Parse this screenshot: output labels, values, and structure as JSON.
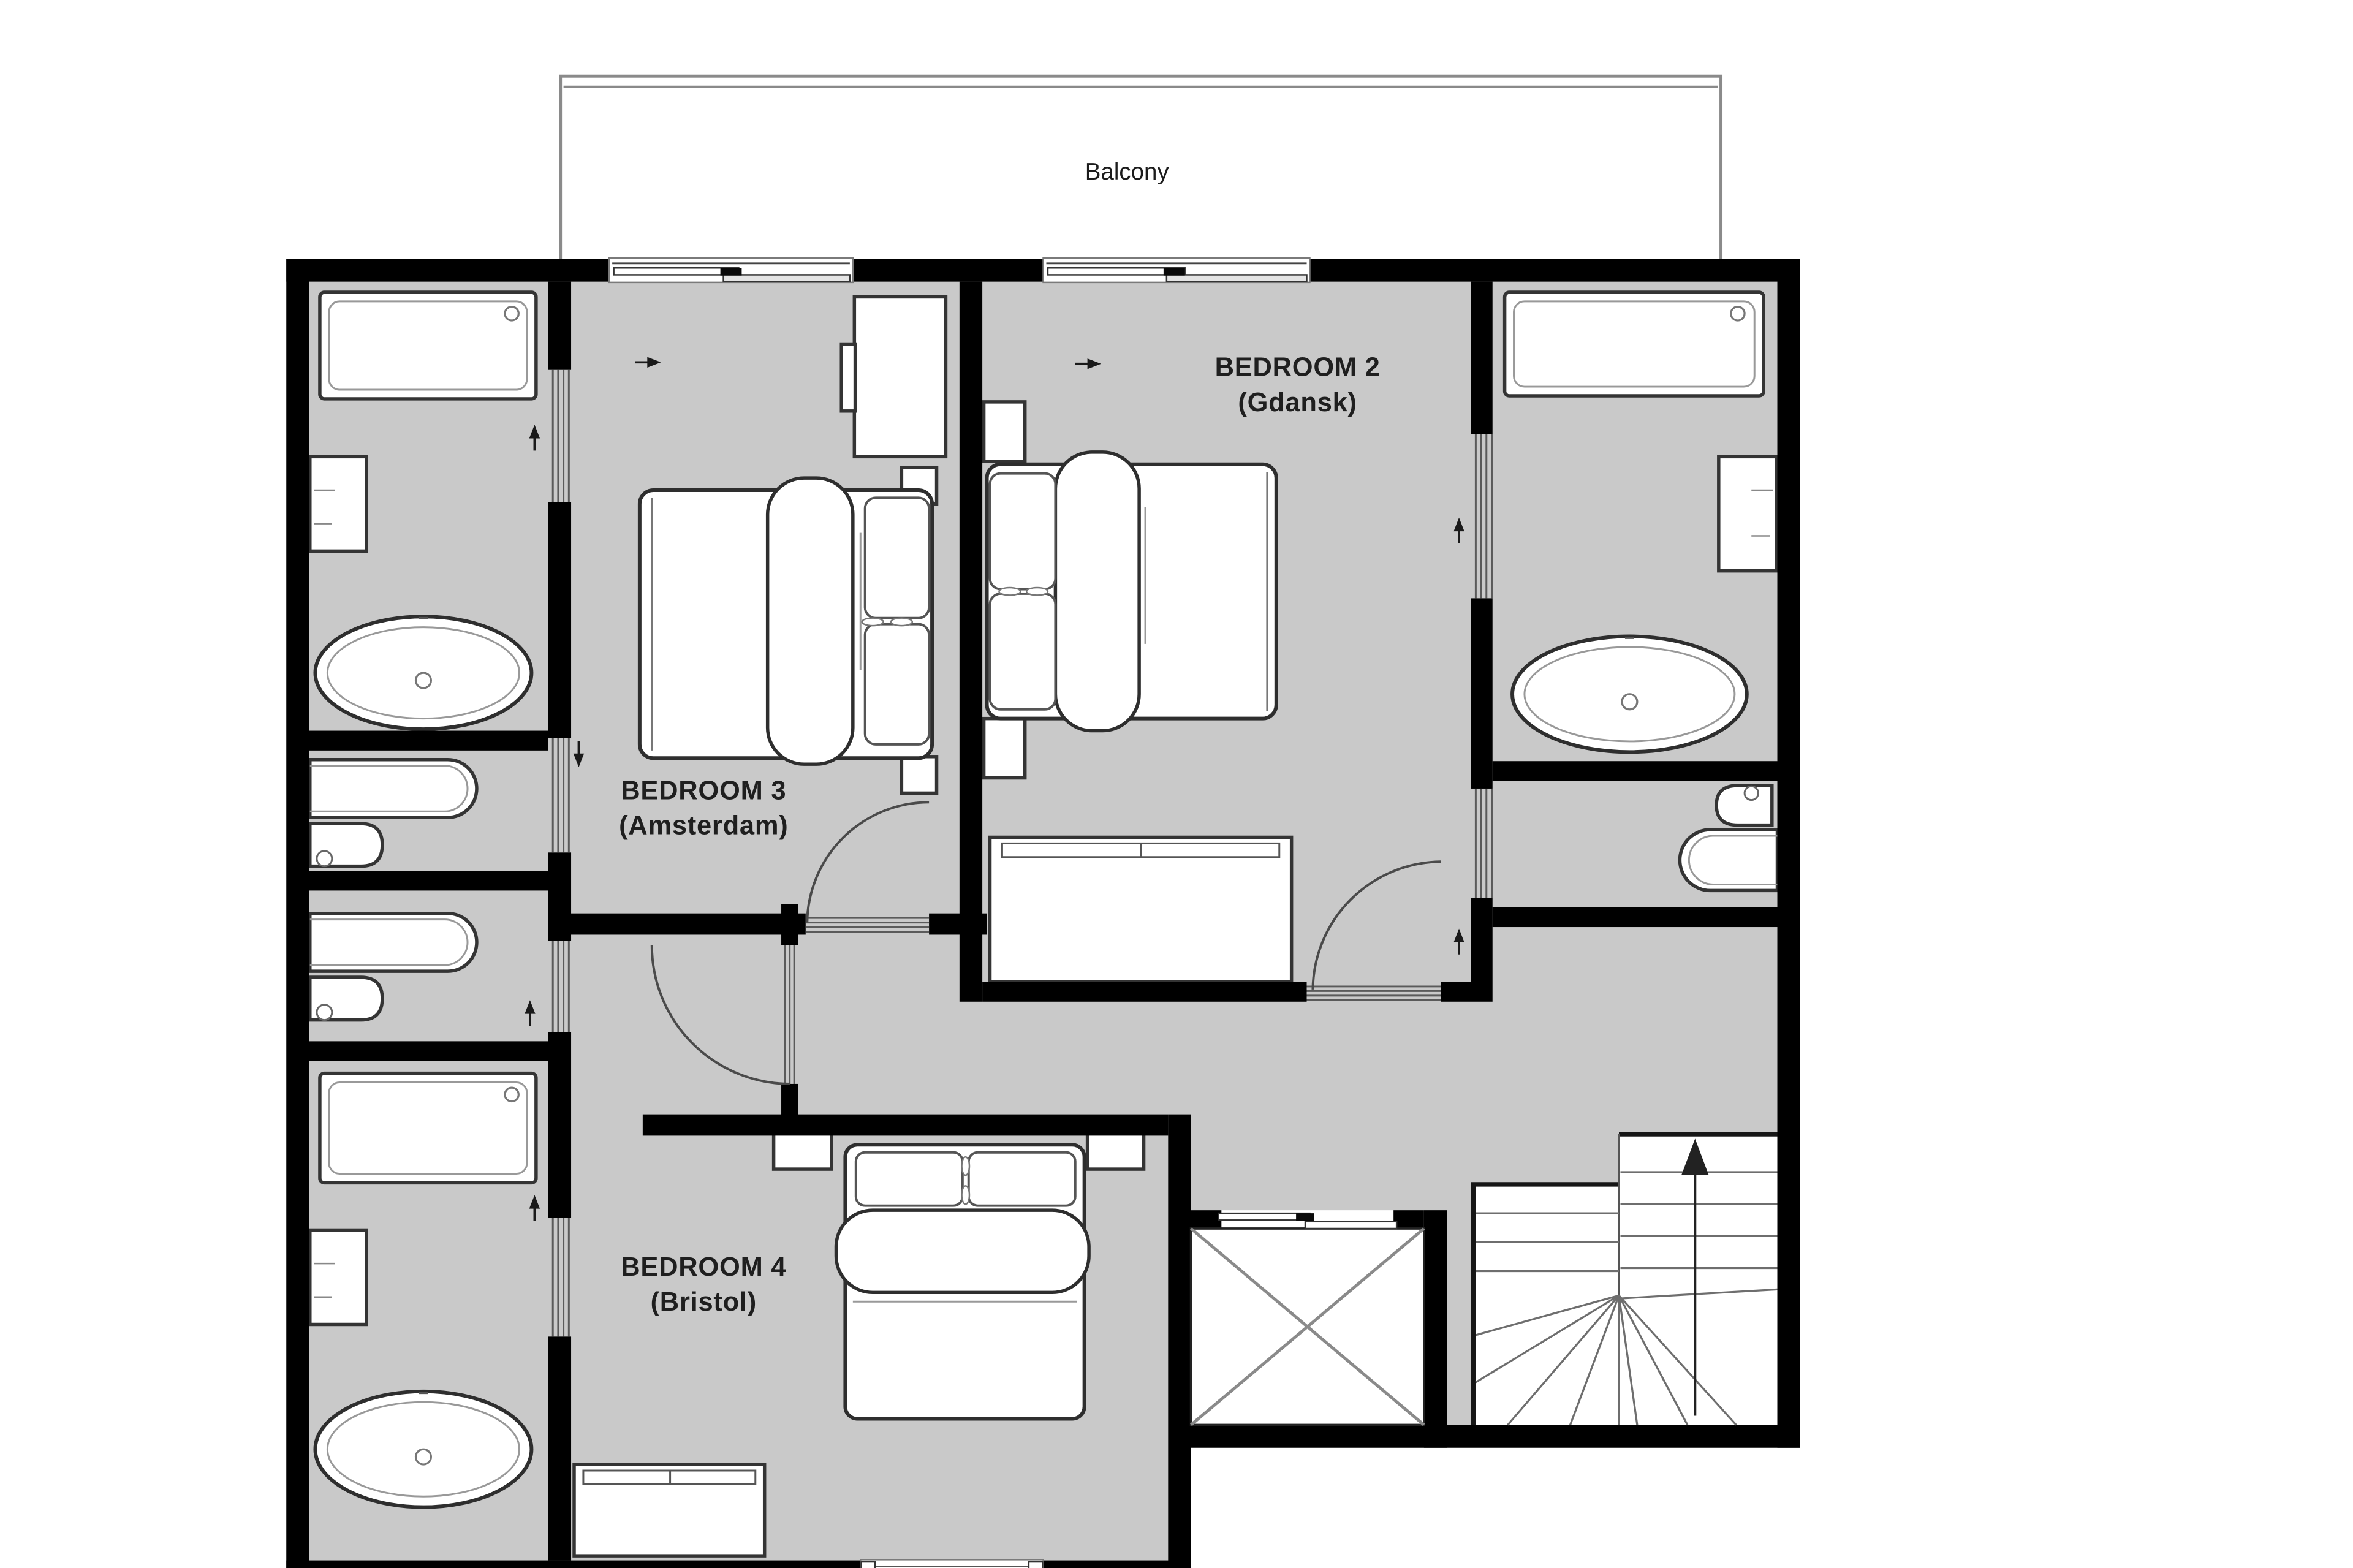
{
  "balcony": {
    "label": "Balcony"
  },
  "rooms": [
    {
      "name": "BEDROOM 2",
      "alias": "(Gdansk)"
    },
    {
      "name": "BEDROOM 3",
      "alias": "(Amsterdam)"
    },
    {
      "name": "BEDROOM 4",
      "alias": "(Bristol)"
    }
  ],
  "icons": {
    "fixtures": [
      "shower-tray",
      "drain",
      "vanity-unit",
      "oval-bathtub",
      "wash-basin",
      "toilet",
      "double-bed",
      "pillows",
      "duvet-roll",
      "nightstand",
      "wardrobe",
      "dresser"
    ],
    "openings": [
      "sliding-door",
      "hinged-door-swing-arc",
      "balcony-sliding-door",
      "window"
    ],
    "circulation": [
      "winder-staircase",
      "stair-up-arrow",
      "elevator-shaft-x"
    ]
  },
  "stairs": {
    "direction_arrow": "up"
  },
  "colors": {
    "background": "#ffffff",
    "floor_fill": "#c9c9c9",
    "wall": "#000000",
    "fixture_outline": "#343434"
  }
}
